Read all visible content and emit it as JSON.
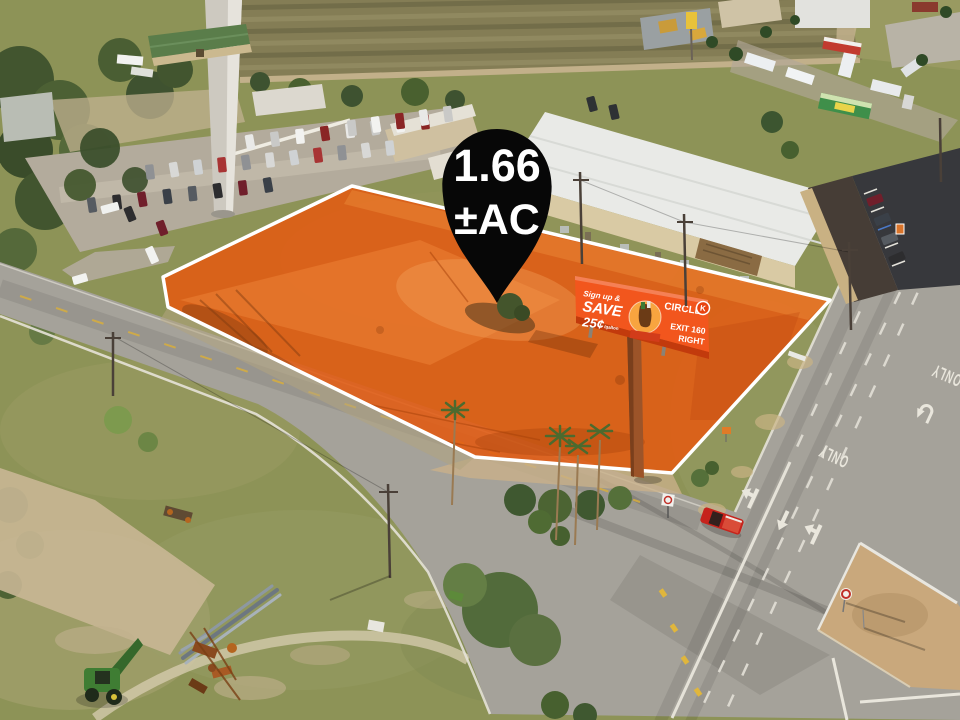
{
  "pin": {
    "value": "1.66",
    "unit": "±AC"
  },
  "billboard": {
    "line1": "Sign up &",
    "line2": "SAVE",
    "price": "25¢",
    "price_unit": "/gallon",
    "brand": "CIRCLE",
    "brand_k": "K",
    "exit1": "EXIT 160",
    "exit2": "RIGHT"
  },
  "road": {
    "only": "ONLY"
  },
  "colors": {
    "parcel_fill": "#e25b12",
    "parcel_outline": "#ffffff",
    "pin_fill": "#070707",
    "pin_text": "#ffffff",
    "billboard_bg": "#f2561d",
    "billboard_frame": "#c23a0c",
    "road_marking": "#e9e6dc",
    "truck_red": "#c6231c",
    "tractor_green": "#3f7d33"
  },
  "scene": {
    "parking": {
      "car_colors": [
        "#e9e9e7",
        "#2d2d2f",
        "#a83434",
        "#c9c9c7",
        "#701f2b",
        "#8f9194",
        "#f2f2f0",
        "#3a4048",
        "#d8d8d6",
        "#8a2525",
        "#565b61",
        "#cfd2d4"
      ],
      "rows": [
        {
          "x1": 250,
          "y1": 142,
          "x2": 425,
          "y2": 122,
          "n": 8,
          "rot": -8
        },
        {
          "x1": 150,
          "y1": 172,
          "x2": 390,
          "y2": 148,
          "n": 11,
          "rot": -8
        },
        {
          "x1": 92,
          "y1": 205,
          "x2": 268,
          "y2": 185,
          "n": 8,
          "rot": -8
        },
        {
          "x1": 352,
          "y1": 128,
          "x2": 448,
          "y2": 114,
          "n": 5,
          "rot": -8,
          "l": 16
        },
        {
          "x1": 110,
          "y1": 208,
          "x2": 110,
          "y2": 208,
          "n": 1,
          "rot": 75,
          "l": 18,
          "c": "#f0f1ef"
        },
        {
          "x1": 130,
          "y1": 214,
          "x2": 162,
          "y2": 228,
          "n": 2,
          "rot": -20
        },
        {
          "x1": 152,
          "y1": 255,
          "x2": 152,
          "y2": 255,
          "n": 1,
          "rot": -25,
          "l": 17,
          "c": "#f2f2f0"
        },
        {
          "x1": 80,
          "y1": 279,
          "x2": 80,
          "y2": 279,
          "n": 1,
          "rot": 75,
          "l": 15,
          "c": "#f2f2f0"
        },
        {
          "x1": 875,
          "y1": 200,
          "x2": 897,
          "y2": 258,
          "n": 4,
          "rot": 68,
          "l": 16
        },
        {
          "x1": 592,
          "y1": 104,
          "x2": 614,
          "y2": 112,
          "n": 2,
          "rot": -15,
          "c": "#2e3134"
        }
      ]
    }
  }
}
